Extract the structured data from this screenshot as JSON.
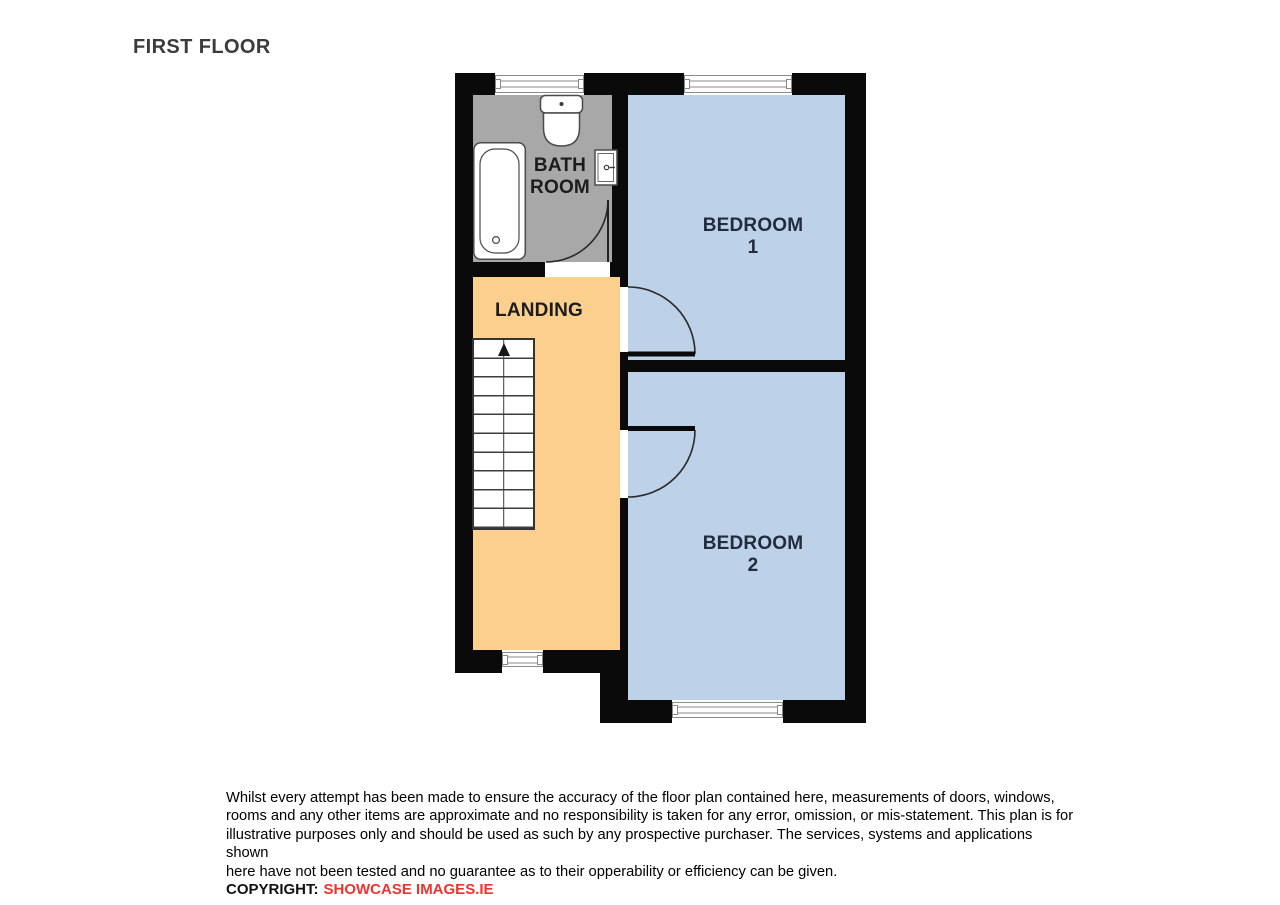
{
  "title": "FIRST FLOOR",
  "floor_plan": {
    "wall_color": "#0a0a0a",
    "rooms": [
      {
        "name": "bathroom",
        "label": "BATH\nROOM",
        "fill": "#a8a8a8"
      },
      {
        "name": "bedroom-1",
        "label": "BEDROOM 1",
        "fill": "#bdd2e8"
      },
      {
        "name": "landing",
        "label": "LANDING",
        "fill": "#fbcf8e"
      },
      {
        "name": "bedroom-2",
        "label": "BEDROOM 2",
        "fill": "#bdd2e8"
      }
    ],
    "fixtures": [
      "toilet",
      "bathtub",
      "sink",
      "staircase"
    ],
    "staircase": {
      "steps": 10,
      "direction_arrow": "up"
    },
    "window_count": 4,
    "door_count": 3
  },
  "disclaimer": "Whilst every attempt has been made to ensure the accuracy of the floor plan contained here, measurements of doors, windows,\nrooms and any other items are approximate and no responsibility is taken for any error, omission, or mis-statement.  This plan is for\nillustrative purposes only and should be used as such by any prospective purchaser.  The services, systems and applications shown\nhere have not been tested and no guarantee as to their opperability or efficiency can be given.",
  "copyright": {
    "label": "COPYRIGHT:",
    "holder": "SHOWCASE IMAGES.IE",
    "holder_color": "#ed3431"
  }
}
